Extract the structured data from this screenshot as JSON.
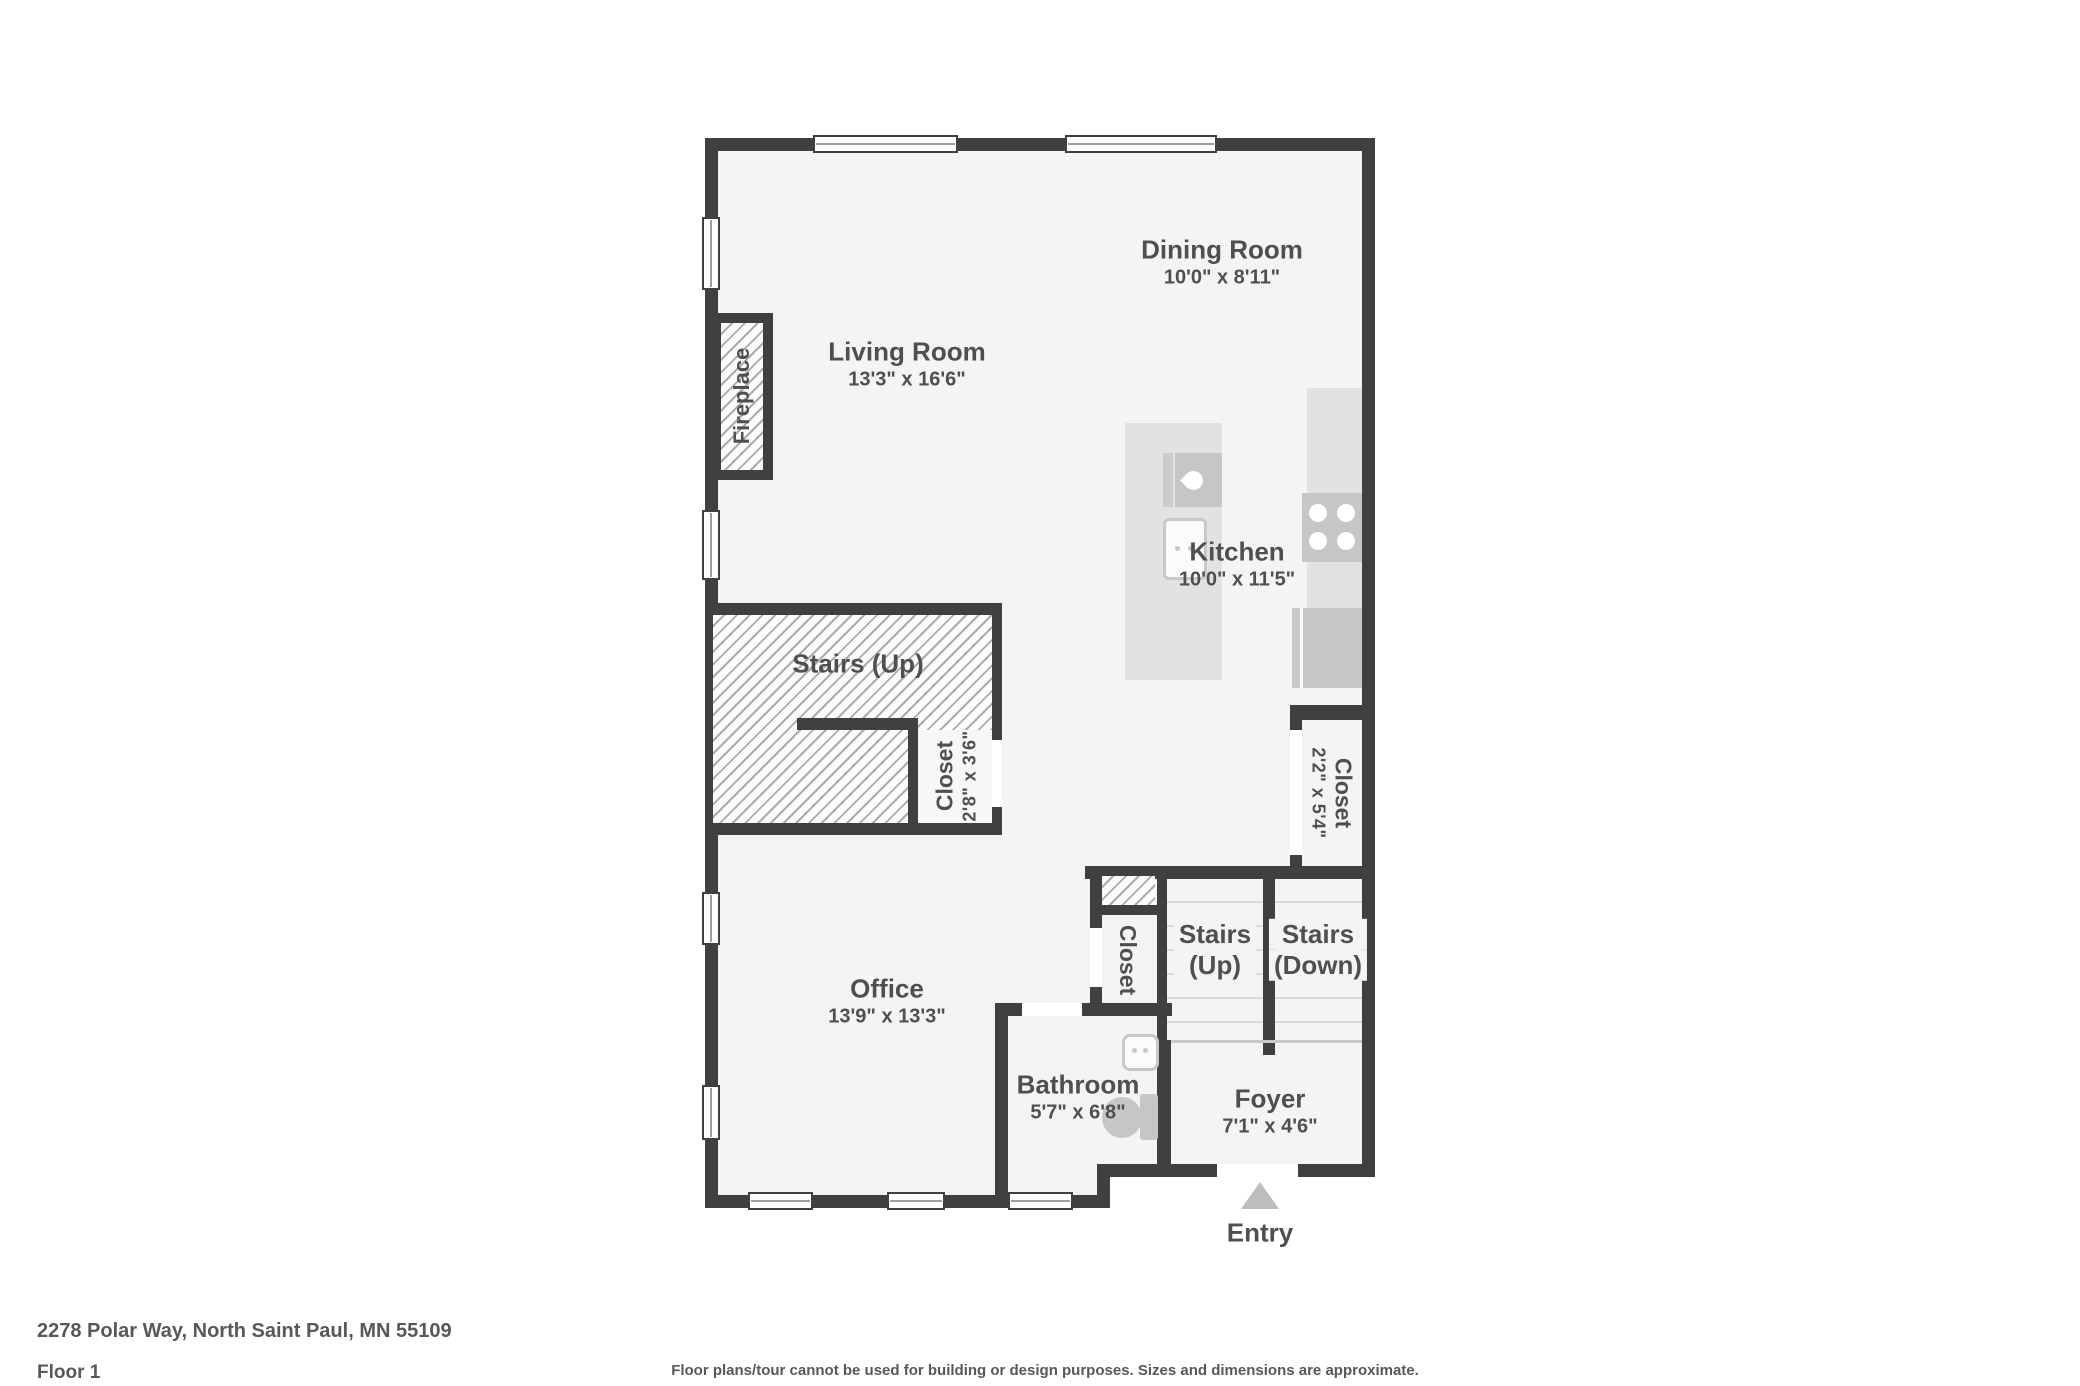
{
  "page": {
    "address": "2278 Polar Way, North Saint Paul, MN 55109",
    "floor_label": "Floor 1",
    "disclaimer": "Floor plans/tour cannot be used for building or design purposes. Sizes and dimensions are approximate."
  },
  "colors": {
    "wall": "#3e4042",
    "floor": "#f4f4f5",
    "text": "#4d5053",
    "muted": "#56585b",
    "counter": "#e2e2e3",
    "appliance": "#c6c6c7",
    "fixline": "#c8c8c9",
    "hatch_line": "#ababab",
    "tread": "#d9d9d9",
    "arrow": "#bdbdbd"
  },
  "rooms": [
    {
      "name": "Living Room",
      "dims": "13'3\" x 16'6\""
    },
    {
      "name": "Dining Room",
      "dims": "10'0\" x 8'11\""
    },
    {
      "name": "Kitchen",
      "dims": "10'0\" x 11'5\""
    },
    {
      "name": "Stairs (Up)"
    },
    {
      "name": "Closet",
      "dims": "2'8\" x 3'6\""
    },
    {
      "name": "Closet",
      "dims": "2'2\" x 5'4\""
    },
    {
      "name": "Closet"
    },
    {
      "name": "Stairs",
      "sub": "(Up)"
    },
    {
      "name": "Stairs",
      "sub": "(Down)"
    },
    {
      "name": "Office",
      "dims": "13'9\" x 13'3\""
    },
    {
      "name": "Bathroom",
      "dims": "5'7\" x 6'8\""
    },
    {
      "name": "Foyer",
      "dims": "7'1\" x 4'6\""
    },
    {
      "name": "Fireplace"
    },
    {
      "name": "Entry"
    }
  ]
}
